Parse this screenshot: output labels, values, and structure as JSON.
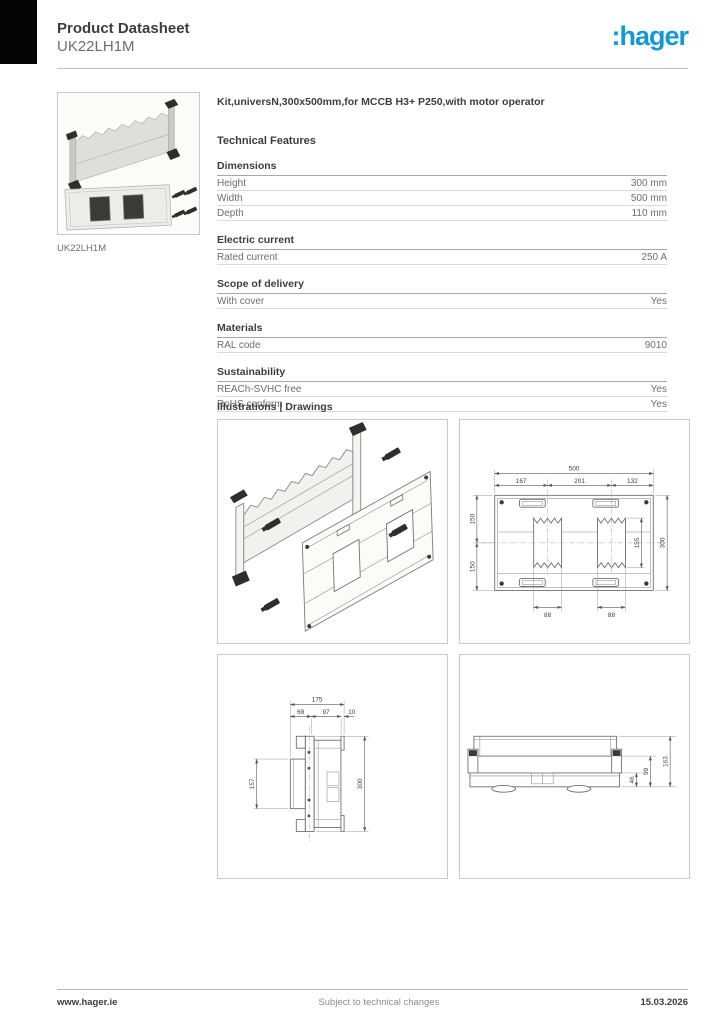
{
  "header": {
    "title": "Product Datasheet",
    "subtitle": "UK22LH1M",
    "logo_text": ":hager",
    "logo_color": "#1499d6"
  },
  "product_image": {
    "caption": "UK22LH1M"
  },
  "product": {
    "title": "Kit,universN,300x500mm,for MCCB H3+ P250,with motor operator"
  },
  "technical": {
    "heading": "Technical Features",
    "sections": [
      {
        "title": "Dimensions",
        "rows": [
          {
            "label": "Height",
            "value": "300 mm"
          },
          {
            "label": "Width",
            "value": "500 mm"
          },
          {
            "label": "Depth",
            "value": "110 mm"
          }
        ]
      },
      {
        "title": "Electric current",
        "rows": [
          {
            "label": "Rated current",
            "value": "250 A"
          }
        ]
      },
      {
        "title": "Scope of delivery",
        "rows": [
          {
            "label": "With cover",
            "value": "Yes"
          }
        ]
      },
      {
        "title": "Materials",
        "rows": [
          {
            "label": "RAL code",
            "value": "9010"
          }
        ]
      },
      {
        "title": "Sustainability",
        "rows": [
          {
            "label": "REACh-SVHC free",
            "value": "Yes"
          },
          {
            "label": "RoHS conform",
            "value": "Yes"
          }
        ]
      }
    ]
  },
  "drawings": {
    "heading": "Illustrations | Drawings",
    "front_view": {
      "overall_width": "500",
      "seg_left": "167",
      "seg_mid": "201",
      "seg_right": "132",
      "half_top": "150",
      "half_bottom": "150",
      "cutout_height": "155",
      "overall_height": "300",
      "cutout1_width": "88",
      "cutout2_width": "88"
    },
    "side_view": {
      "overall_depth": "175",
      "seg1": "68",
      "seg2": "97",
      "seg3": "10",
      "cover_height": "157",
      "overall_height": "300"
    },
    "bottom_view": {
      "depth_inner": "46",
      "depth_mid": "99",
      "depth_outer": "163"
    }
  },
  "footer": {
    "website": "www.hager.ie",
    "notice": "Subject to technical changes",
    "date": "15.03.2026"
  }
}
